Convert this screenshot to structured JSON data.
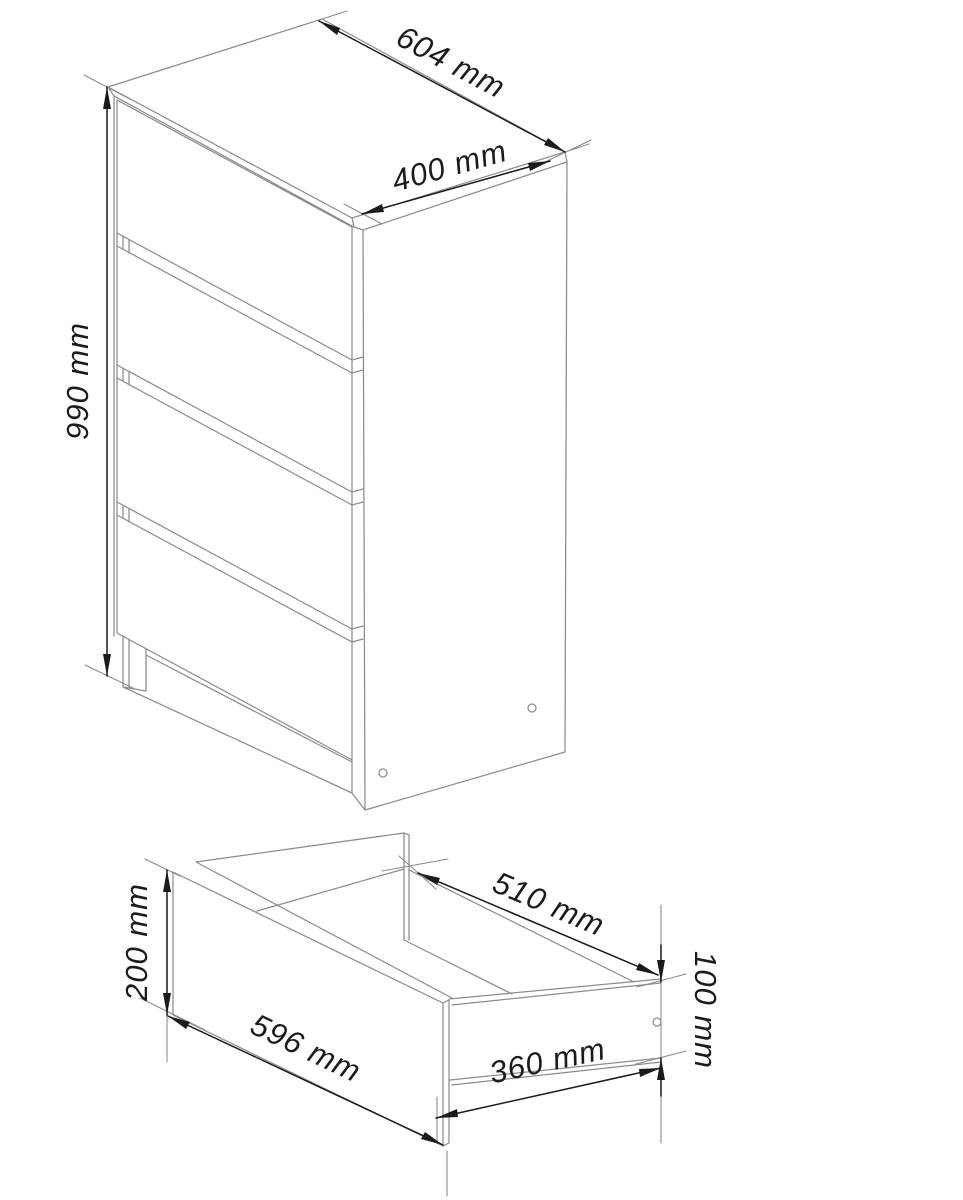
{
  "drawing": {
    "type": "furniture-technical-diagram",
    "background_color": "#ffffff",
    "outline_color": "#8c8c8c",
    "dimension_color": "#1b1b1b"
  },
  "cabinet_view": {
    "drawer_count": 4,
    "dimensions": {
      "width": "604 mm",
      "depth": "400 mm",
      "height": "990 mm"
    }
  },
  "drawer_view": {
    "dimensions": {
      "front_width": "596 mm",
      "front_height": "200 mm",
      "depth": "510 mm",
      "side_height": "100 mm",
      "bottom_width": "360 mm"
    }
  }
}
